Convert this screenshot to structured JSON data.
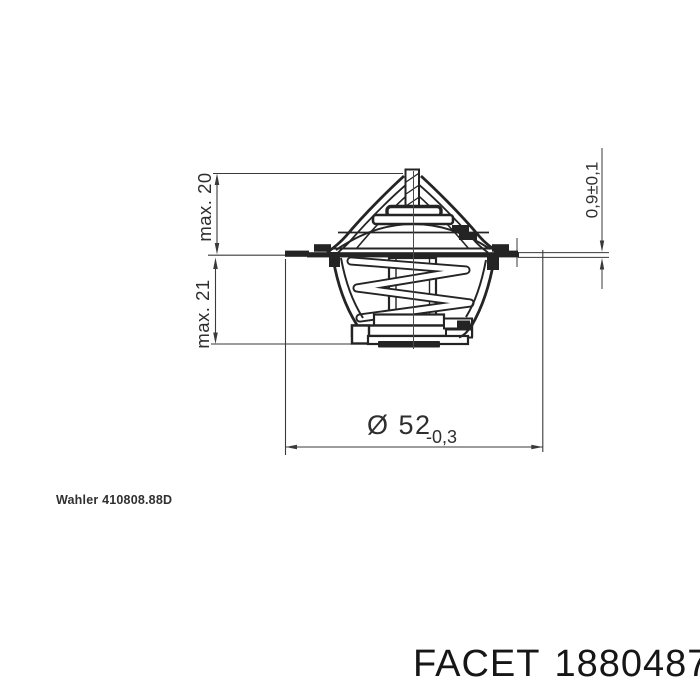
{
  "labels": {
    "manufacturer_ref": "Wahler 410808.88D",
    "brand": "FACET",
    "part_number": "1880487"
  },
  "dimensions": {
    "height_upper": "max. 20",
    "height_lower": "max. 21",
    "diameter": "Ø 52",
    "diameter_tolerance": "-0,3",
    "flange_thickness": "0,9±0,1"
  },
  "colors": {
    "background": "#ffffff",
    "part_line": "#242424",
    "dimension_line": "#3a3a3a",
    "text": "#1a1a1a"
  }
}
